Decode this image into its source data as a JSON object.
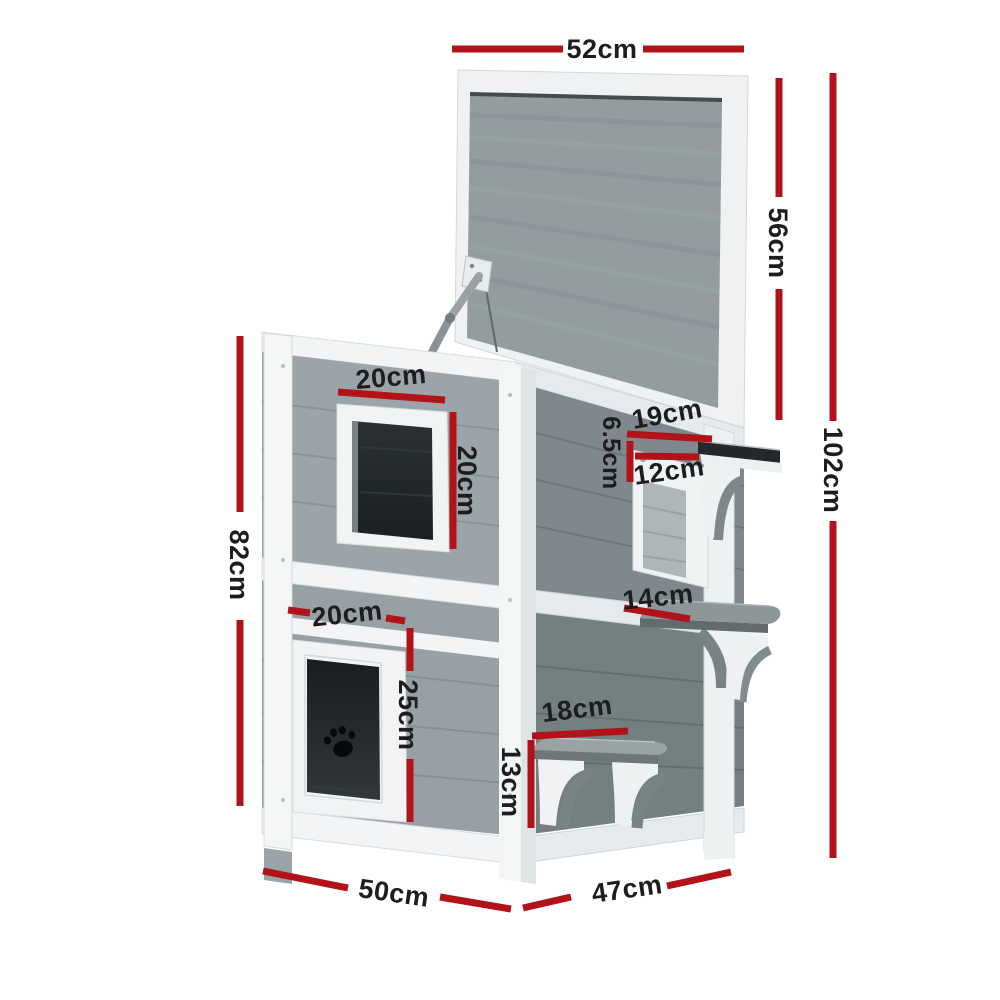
{
  "diagram": {
    "name": "two-storey pet house dimension diagram",
    "unit": "cm",
    "dimensions": [
      {
        "id": "lid-width",
        "label": "52cm"
      },
      {
        "id": "lid-panel-height",
        "label": "56cm"
      },
      {
        "id": "total-height",
        "label": "102cm"
      },
      {
        "id": "window-width",
        "label": "20cm"
      },
      {
        "id": "window-height",
        "label": "20cm"
      },
      {
        "id": "shelf-depth",
        "label": "19cm"
      },
      {
        "id": "shelf-drop",
        "label": "6.5cm"
      },
      {
        "id": "balcony-opening-width",
        "label": "12cm"
      },
      {
        "id": "middle-step-depth",
        "label": "14cm"
      },
      {
        "id": "body-height",
        "label": "82cm"
      },
      {
        "id": "door-width",
        "label": "20cm"
      },
      {
        "id": "door-height",
        "label": "25cm"
      },
      {
        "id": "bottom-step-width",
        "label": "18cm"
      },
      {
        "id": "bottom-step-height",
        "label": "13cm"
      },
      {
        "id": "base-depth",
        "label": "50cm"
      },
      {
        "id": "base-width",
        "label": "47cm"
      }
    ]
  },
  "colors": {
    "accent": "#b11318",
    "ink": "#1d1d1f",
    "bg": "#ffffff",
    "trim": "#f2f4f5",
    "trim_shade": "#e6eaec",
    "lid_panel": "#939da0",
    "wall_front_upper": "#9ba5a9",
    "wall_front_lower": "#97a1a5",
    "wall_side_upper": "#7f898d",
    "wall_side_lower": "#747f82",
    "glass": "#22272a",
    "step_gray": "#99a2a5",
    "metal": "#8f979b"
  }
}
